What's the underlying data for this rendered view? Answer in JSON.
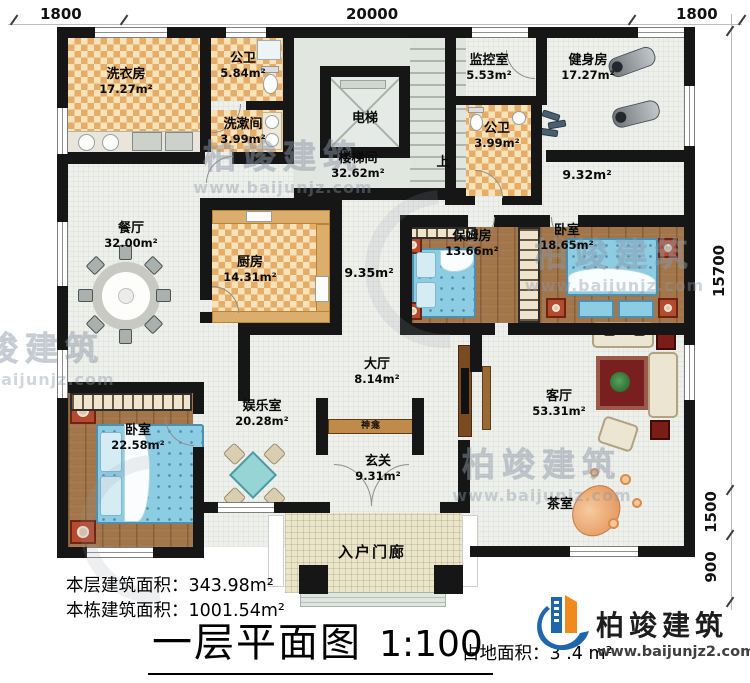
{
  "title": {
    "text": "一层平面图",
    "scale": "1:100"
  },
  "stats": {
    "floor_area_label": "本层建筑面积：",
    "floor_area_value": "343.98m²",
    "building_area_label": "本栋建筑面积：",
    "building_area_value": "1001.54m²",
    "land_area_label": "占地面积：",
    "land_area_value": "3  .4 m²"
  },
  "brand": {
    "name": "柏竣建筑",
    "url": "www.baijunjz2.com"
  },
  "watermark": {
    "name": "柏竣建筑",
    "url": "www.baijunjz.com"
  },
  "dimensions": {
    "top": [
      "1800",
      "20000",
      "1800"
    ],
    "right": [
      "15700",
      "1500",
      "900"
    ]
  },
  "colors": {
    "wall": "#161616",
    "tile": "#e5ad67",
    "wood": "#a2764a",
    "bed": "#8ccde4",
    "brand_blue": "#1f66ad",
    "brand_orange": "#f08a1d"
  },
  "rooms": [
    {
      "name": "洗衣房",
      "area": "17.27m²"
    },
    {
      "name": "公卫",
      "area": "5.84m²"
    },
    {
      "name": "洗漱间",
      "area": "3.99m²"
    },
    {
      "name": "电梯",
      "area": ""
    },
    {
      "name": "楼梯间",
      "area": "32.62m²"
    },
    {
      "name": "监控室",
      "area": "5.53m²"
    },
    {
      "name": "健身房",
      "area": "17.27m²"
    },
    {
      "name": "公卫",
      "area": "3.99m²"
    },
    {
      "name": "",
      "area": "9.32m²"
    },
    {
      "name": "餐厅",
      "area": "32.00m²"
    },
    {
      "name": "厨房",
      "area": "14.31m²"
    },
    {
      "name": "",
      "area": "9.35m²"
    },
    {
      "name": "保姆房",
      "area": "13.66m²"
    },
    {
      "name": "卧室",
      "area": "18.65m²"
    },
    {
      "name": "大厅",
      "area": "8.14m²"
    },
    {
      "name": "娱乐室",
      "area": "20.28m²"
    },
    {
      "name": "神龛",
      "area": ""
    },
    {
      "name": "玄关",
      "area": "9.31m²"
    },
    {
      "name": "卧室",
      "area": "22.58m²"
    },
    {
      "name": "客厅",
      "area": "53.31m²"
    },
    {
      "name": "茶室",
      "area": ""
    },
    {
      "name": "入户门廊",
      "area": ""
    },
    {
      "name": "上",
      "area": ""
    }
  ]
}
